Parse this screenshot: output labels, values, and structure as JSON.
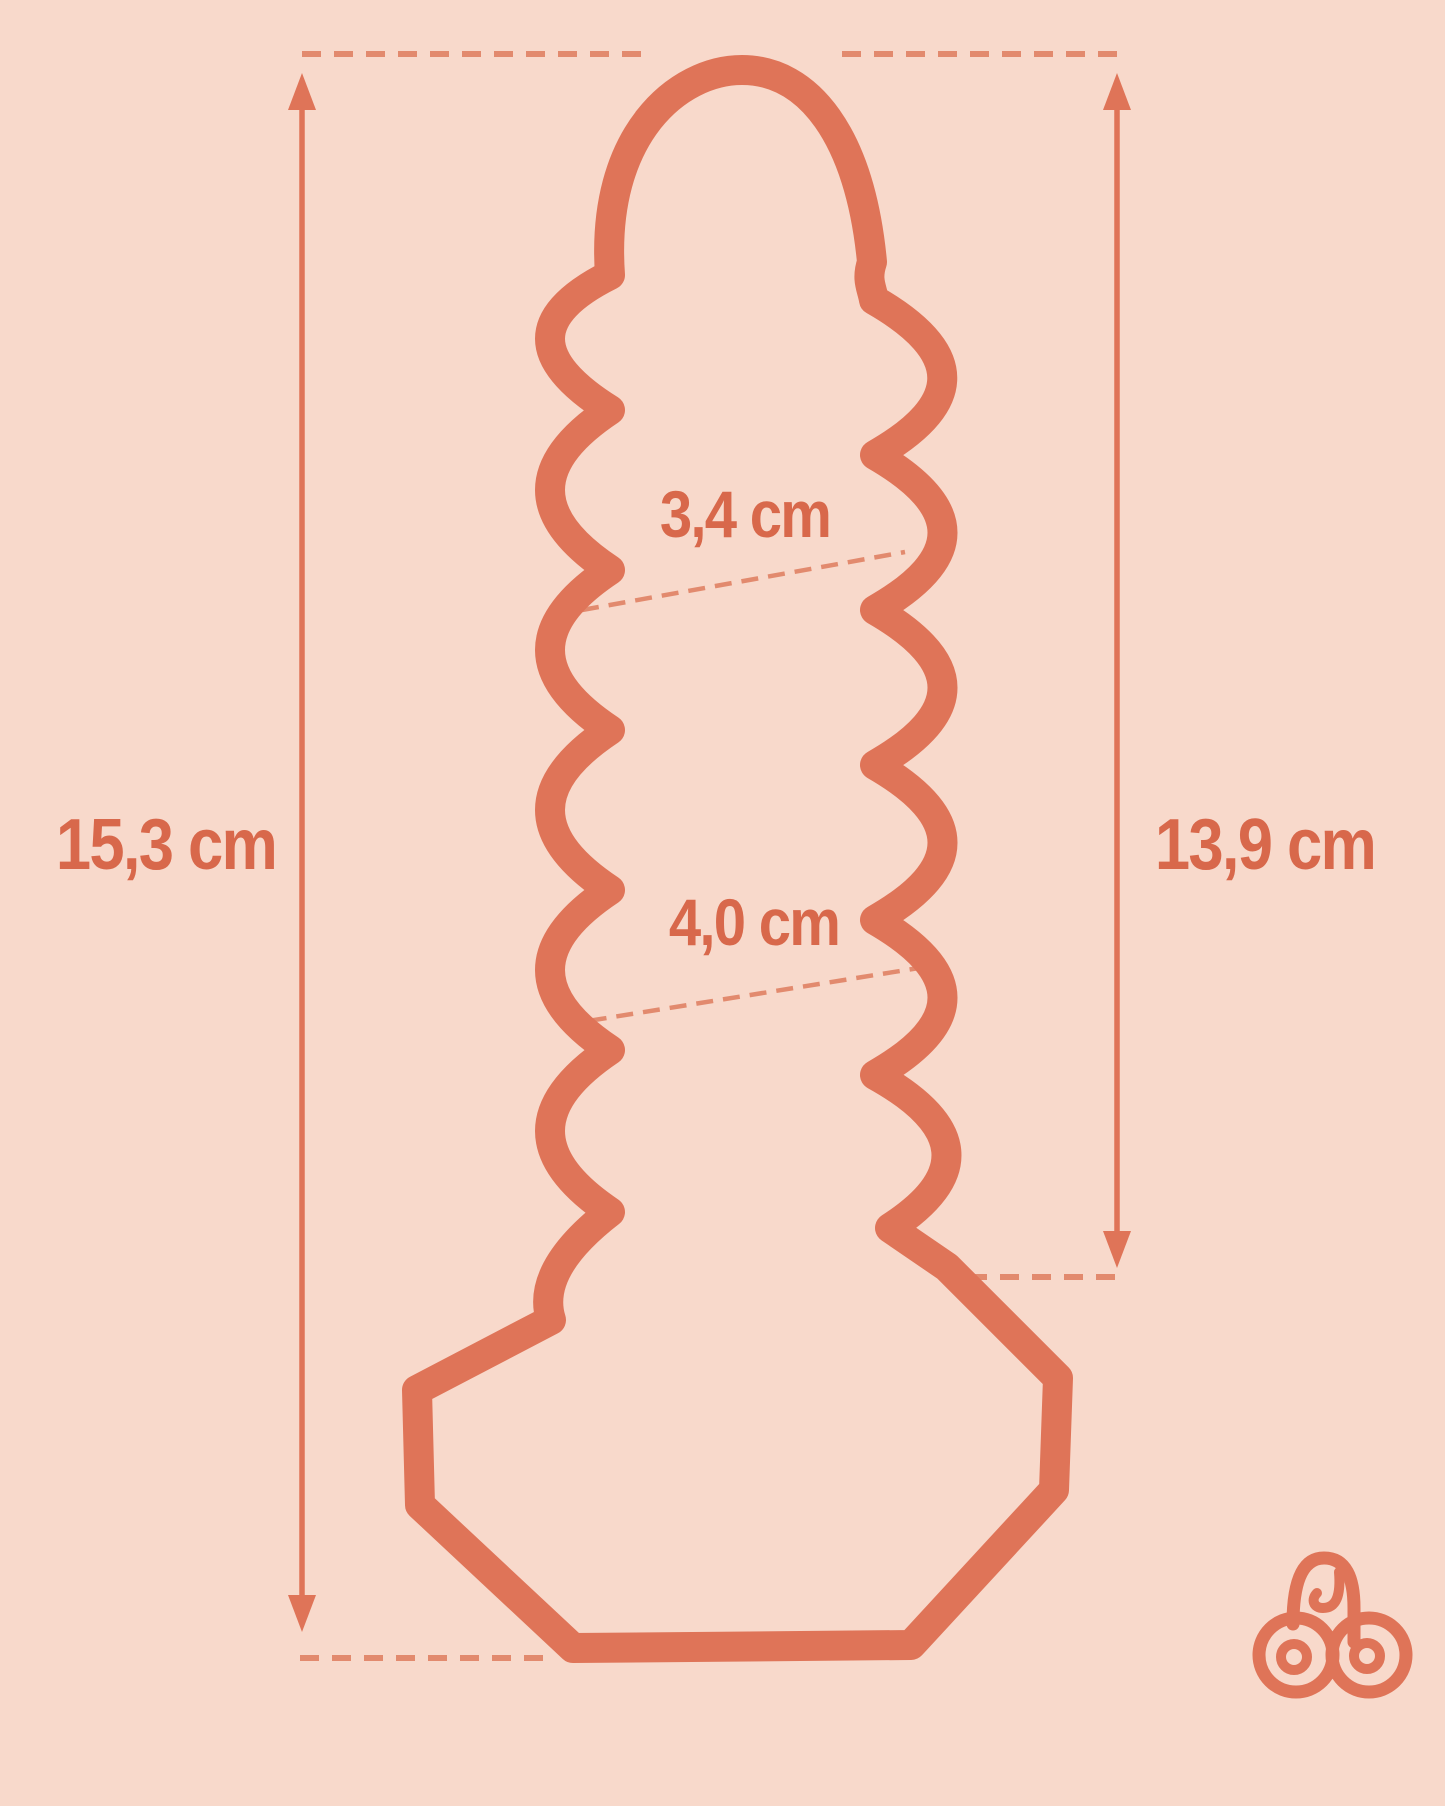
{
  "diagram": {
    "type": "product-dimension-diagram",
    "measurements": {
      "total_length": "15,3 cm",
      "insertable_length": "13,9 cm",
      "upper_diameter": "3,4 cm",
      "lower_diameter": "4,0 cm"
    },
    "logo": {
      "text": "ab"
    },
    "colors": {
      "background": "#f8d9cb",
      "outline": "#df7458",
      "dashed": "#e28a6e",
      "text": "#d8684b"
    }
  }
}
